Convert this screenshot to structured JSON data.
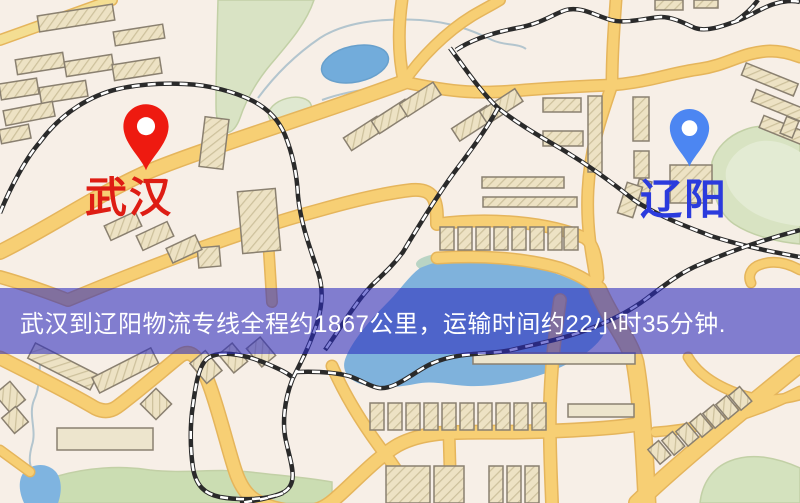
{
  "map": {
    "origin": {
      "label": "武汉"
    },
    "destination": {
      "label": "辽阳"
    }
  },
  "banner": {
    "text": "武汉到辽阳物流专线全程约1867公里，运输时间约22小时35分钟."
  },
  "colors": {
    "origin_pin": "#ee1a10",
    "origin_label": "#de1d14",
    "destination_pin": "#4c86f2",
    "destination_label": "#2b3bdd",
    "banner_background": "rgba(43,43,190,0.58)",
    "banner_text": "#ffffff",
    "map_background": "#f7efe7",
    "road": "#f7cf74",
    "road_casing": "#e5b55c",
    "park": "#d8e3c4",
    "water": "#72acdb",
    "railway": "#2a2a2a",
    "building": "#ede2c4"
  }
}
